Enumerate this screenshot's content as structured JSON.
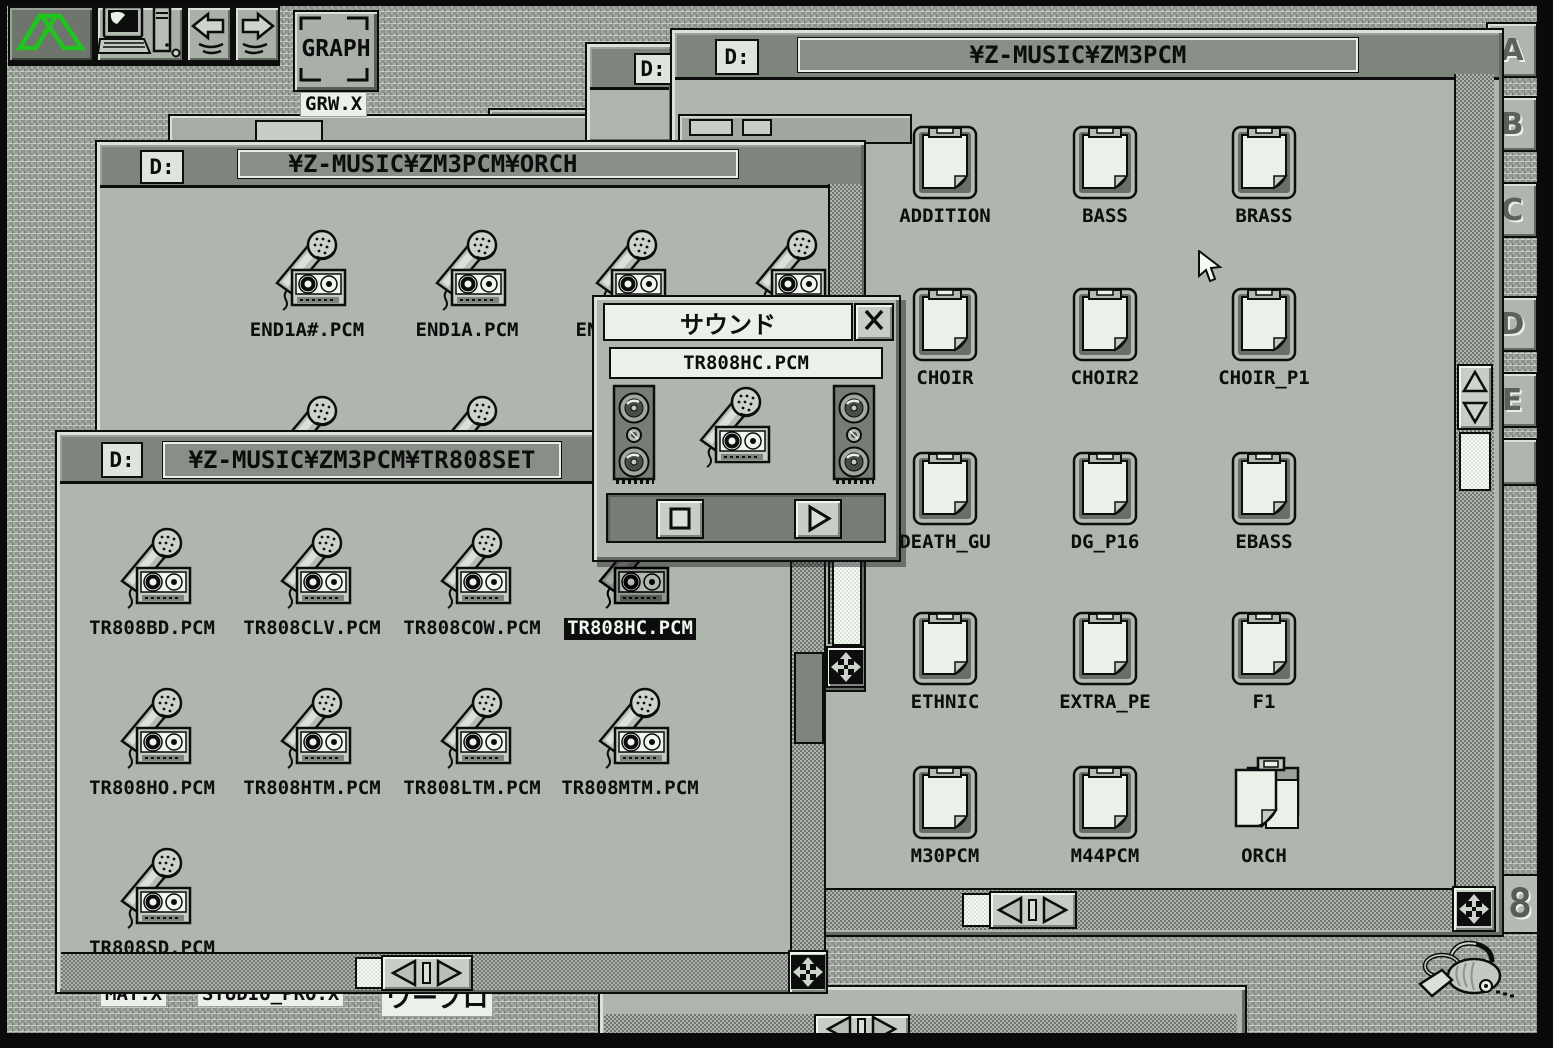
{
  "toolbar": {
    "graph_label": "GRAPH",
    "graph_caption": "GRW.X",
    "buttons": [
      "sx-window-logo",
      "computer",
      "copy-left-arrow",
      "copy-right-arrow"
    ]
  },
  "drive_tabs": {
    "labels": [
      "A",
      "B",
      "C",
      "D",
      "E"
    ]
  },
  "windows": {
    "zm3pcm": {
      "drive": "D:",
      "title": "¥Z-MUSIC¥ZM3PCM",
      "icons": [
        "ADDITION",
        "BASS",
        "BRASS",
        "CHOIR",
        "CHOIR2",
        "CHOIR_P1",
        "DEATH_GU",
        "DG_P16",
        "EBASS",
        "ETHNIC",
        "EXTRA_PE",
        "F1",
        "M30PCM",
        "M44PCM",
        "ORCH"
      ]
    },
    "orch": {
      "drive": "D:",
      "title": "¥Z-MUSIC¥ZM3PCM¥ORCH",
      "icons": [
        "END1A#.PCM",
        "END1A.PCM",
        "END1B.PCM"
      ]
    },
    "tr808set": {
      "drive": "D:",
      "title": "¥Z-MUSIC¥ZM3PCM¥TR808SET",
      "icons": [
        "TR808BD.PCM",
        "TR808CLV.PCM",
        "TR808COW.PCM",
        "TR808HC.PCM",
        "TR808HO.PCM",
        "TR808HTM.PCM",
        "TR808LTM.PCM",
        "TR808MTM.PCM",
        "TR808SD.PCM"
      ],
      "selected_icon": "TR808HC.PCM"
    },
    "background_window": {
      "drive": "D:"
    }
  },
  "sound_dialog": {
    "title": "サウンド",
    "filename": "TR808HC.PCM"
  },
  "desktop": {
    "labels": {
      "mat": "MAT.X",
      "studio": "STUDIO_PRO.X",
      "wapuro": "ワープロ"
    },
    "partial_icon_text": "8"
  },
  "icons": {
    "pcm_file": "microphone-cassette",
    "directory": "clipboard-page",
    "directory_open": "clipboard-pages-open",
    "trash": "vacuum-cleaner",
    "pointer": "arrow-cursor",
    "dialog_close": "x-icon",
    "speaker": "three-way-speaker"
  },
  "colors": {
    "desktop": "#9aa29a",
    "window": "#aeb6ae",
    "titlebar": "#7d857d",
    "field_light": "#e9f1e9",
    "selection": "#0d0d0d",
    "logo_green": "#1fc41f"
  }
}
